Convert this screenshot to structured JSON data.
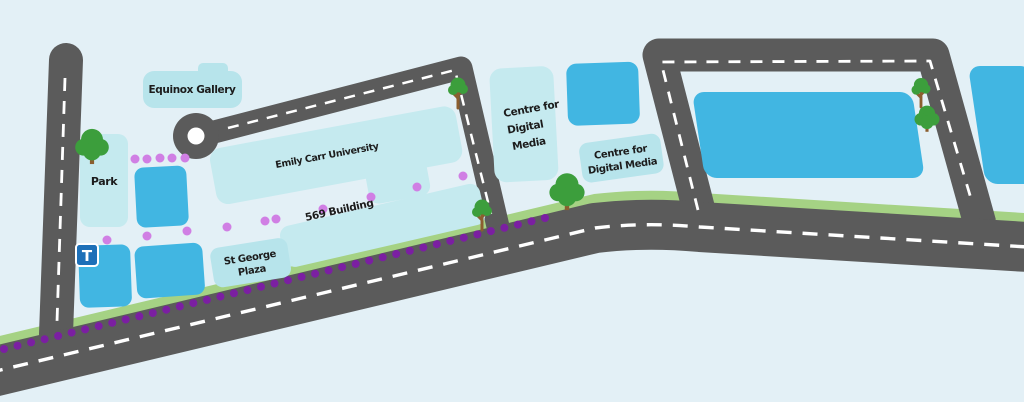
{
  "colors": {
    "background": "#e3f0f6",
    "road": "#5b5b5b",
    "road_line": "#ffffff",
    "green_strip": "#a5d284",
    "building_light": "#c5eaef",
    "label_chip": "#b7e4eb",
    "building_blue": "#41b6e2",
    "dot_dark": "#7b1fa2",
    "dot_light": "#d07fe4",
    "tree_green": "#3c9e3c",
    "tree_trunk": "#8b5e2f",
    "transit_blue": "#1d70b8",
    "roundabout_center": "#ffffff",
    "text": "#1c1c1c"
  },
  "labels": {
    "equinox_gallery": "Equinox Gallery",
    "park": "Park",
    "emily_carr": "Emily Carr University",
    "building_569": "569 Building",
    "st_george_line1": "St George",
    "st_george_line2": "Plaza",
    "cdm_left_line1": "Centre for",
    "cdm_left_line2": "Digital",
    "cdm_left_line3": "Media",
    "cdm_right_line1": "Centre for",
    "cdm_right_line2": "Digital Media",
    "transit_marker": "T"
  },
  "map_features": {
    "dark_dot_trail": {
      "x_start": 4,
      "y_start": 349,
      "x_end": 545,
      "y_end": 218,
      "count": 41,
      "radius": 4
    },
    "light_dot_radius": 4.5,
    "light_dots": [
      [
        135,
        159
      ],
      [
        147,
        159
      ],
      [
        160,
        158
      ],
      [
        172,
        158
      ],
      [
        185,
        158
      ],
      [
        107,
        240
      ],
      [
        147,
        236
      ],
      [
        187,
        231
      ],
      [
        227,
        227
      ],
      [
        265,
        221
      ],
      [
        276,
        219
      ],
      [
        323,
        209
      ],
      [
        371,
        197
      ],
      [
        417,
        187
      ],
      [
        463,
        176
      ]
    ],
    "trees": [
      {
        "x": 92,
        "y": 163,
        "type": "round",
        "scale": 1.05
      },
      {
        "x": 458,
        "y": 107,
        "type": "branchy",
        "scale": 1.0
      },
      {
        "x": 482,
        "y": 229,
        "type": "branchy",
        "scale": 1.0
      },
      {
        "x": 567,
        "y": 209,
        "type": "round",
        "scale": 1.1
      },
      {
        "x": 921,
        "y": 106,
        "type": "branchy",
        "scale": 0.95
      },
      {
        "x": 927,
        "y": 131,
        "type": "round",
        "scale": 0.78
      }
    ]
  }
}
